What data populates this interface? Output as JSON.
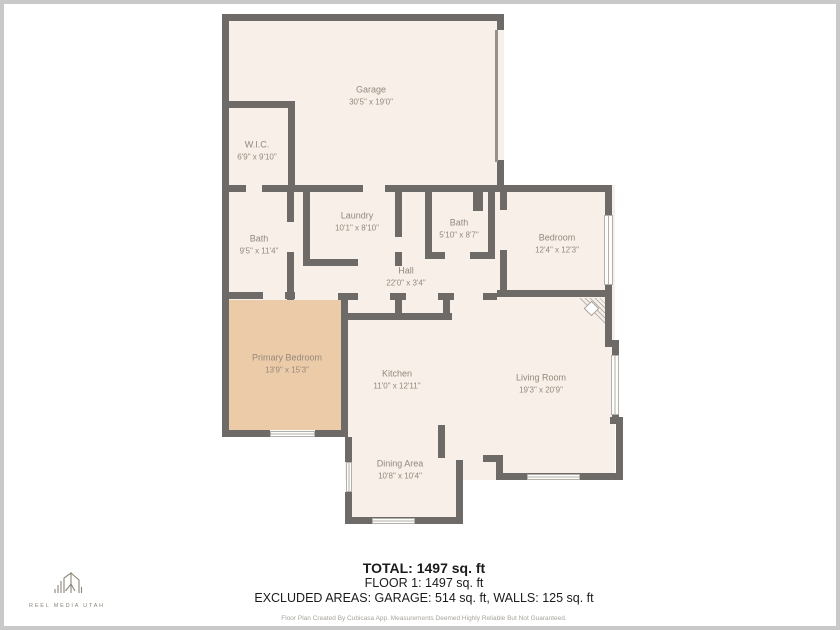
{
  "rooms": [
    {
      "id": "garage",
      "name": "Garage",
      "dims": "30'5\" x 19'0\""
    },
    {
      "id": "wic",
      "name": "W.I.C.",
      "dims": "6'9\" x 9'10\""
    },
    {
      "id": "bath-primary",
      "name": "Bath",
      "dims": "9'5\" x 11'4\""
    },
    {
      "id": "laundry",
      "name": "Laundry",
      "dims": "10'1\" x 8'10\""
    },
    {
      "id": "bath-hall",
      "name": "Bath",
      "dims": "5'10\" x 8'7\""
    },
    {
      "id": "bedroom",
      "name": "Bedroom",
      "dims": "12'4\" x 12'3\""
    },
    {
      "id": "hall",
      "name": "Hall",
      "dims": "22'0\" x 3'4\""
    },
    {
      "id": "primary-bedroom",
      "name": "Primary Bedroom",
      "dims": "13'9\" x 15'3\""
    },
    {
      "id": "kitchen",
      "name": "Kitchen",
      "dims": "11'0\" x 12'11\""
    },
    {
      "id": "living-room",
      "name": "Living Room",
      "dims": "19'3\" x 20'9\""
    },
    {
      "id": "dining-area",
      "name": "Dining Area",
      "dims": "10'8\" x 10'4\""
    }
  ],
  "summary": {
    "total": "TOTAL: 1497 sq. ft",
    "floor1": "FLOOR 1: 1497 sq. ft",
    "excluded": "EXCLUDED AREAS: GARAGE: 514 sq. ft, WALLS: 125 sq. ft",
    "disclaimer": "Floor Plan Created By Cubicasa App. Measurements Deemed Highly Reliable But Not Guaranteed."
  },
  "logo": {
    "text": "REEL MEDIA UTAH"
  },
  "colors": {
    "wall": "#6e6a67",
    "cream": "#f7efe8",
    "blue": "#d3e1e3",
    "peach": "#eccba9",
    "border": "#c9c9c9"
  }
}
